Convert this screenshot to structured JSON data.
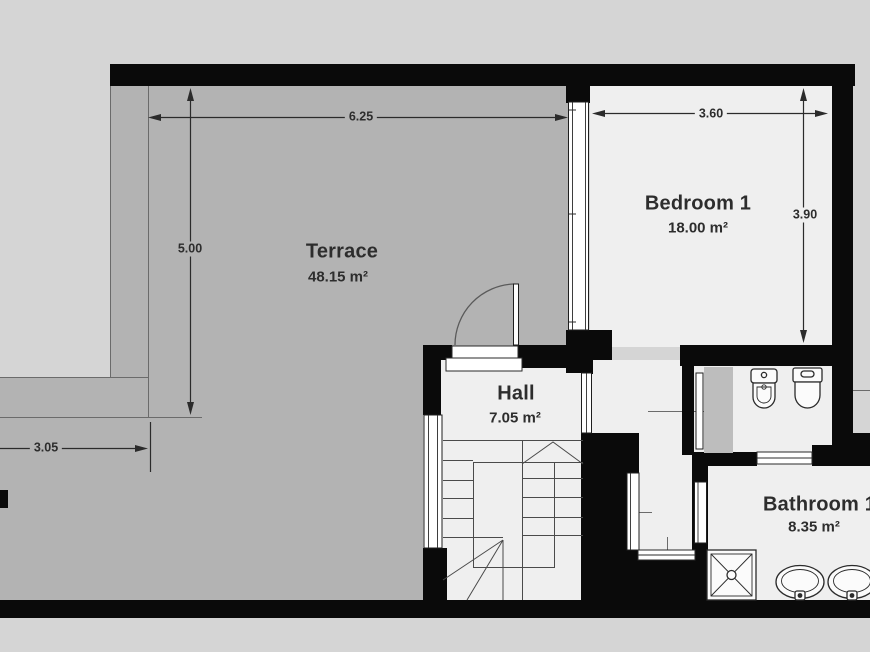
{
  "plan": {
    "title": "First floor plan",
    "rooms": [
      {
        "name": "Terrace",
        "area": "48.15 m²"
      },
      {
        "name": "Bedroom 1",
        "area": "18.00 m²"
      },
      {
        "name": "Hall",
        "area": "7.05 m²"
      },
      {
        "name": "Bathroom 1",
        "area": "8.35 m²"
      }
    ],
    "dimensions": [
      {
        "value": "6.25",
        "edge": "terrace-width"
      },
      {
        "value": "5.00",
        "edge": "terrace-height"
      },
      {
        "value": "3.05",
        "edge": "terrace-left-width"
      },
      {
        "value": "3.60",
        "edge": "bedroom-width"
      },
      {
        "value": "3.90",
        "edge": "bedroom-height"
      }
    ],
    "fixtures": [
      "stairs",
      "door",
      "bidet",
      "toilet",
      "shower",
      "sink",
      "sink"
    ]
  },
  "colors": {
    "bg": "#d5d5d5",
    "terrace": "#b3b3b3",
    "floor": "#efefef",
    "wall": "#0a0a0a",
    "panel": "#bdbdbd",
    "dim": "#2b2b2b",
    "text": "#2d2d2d"
  }
}
